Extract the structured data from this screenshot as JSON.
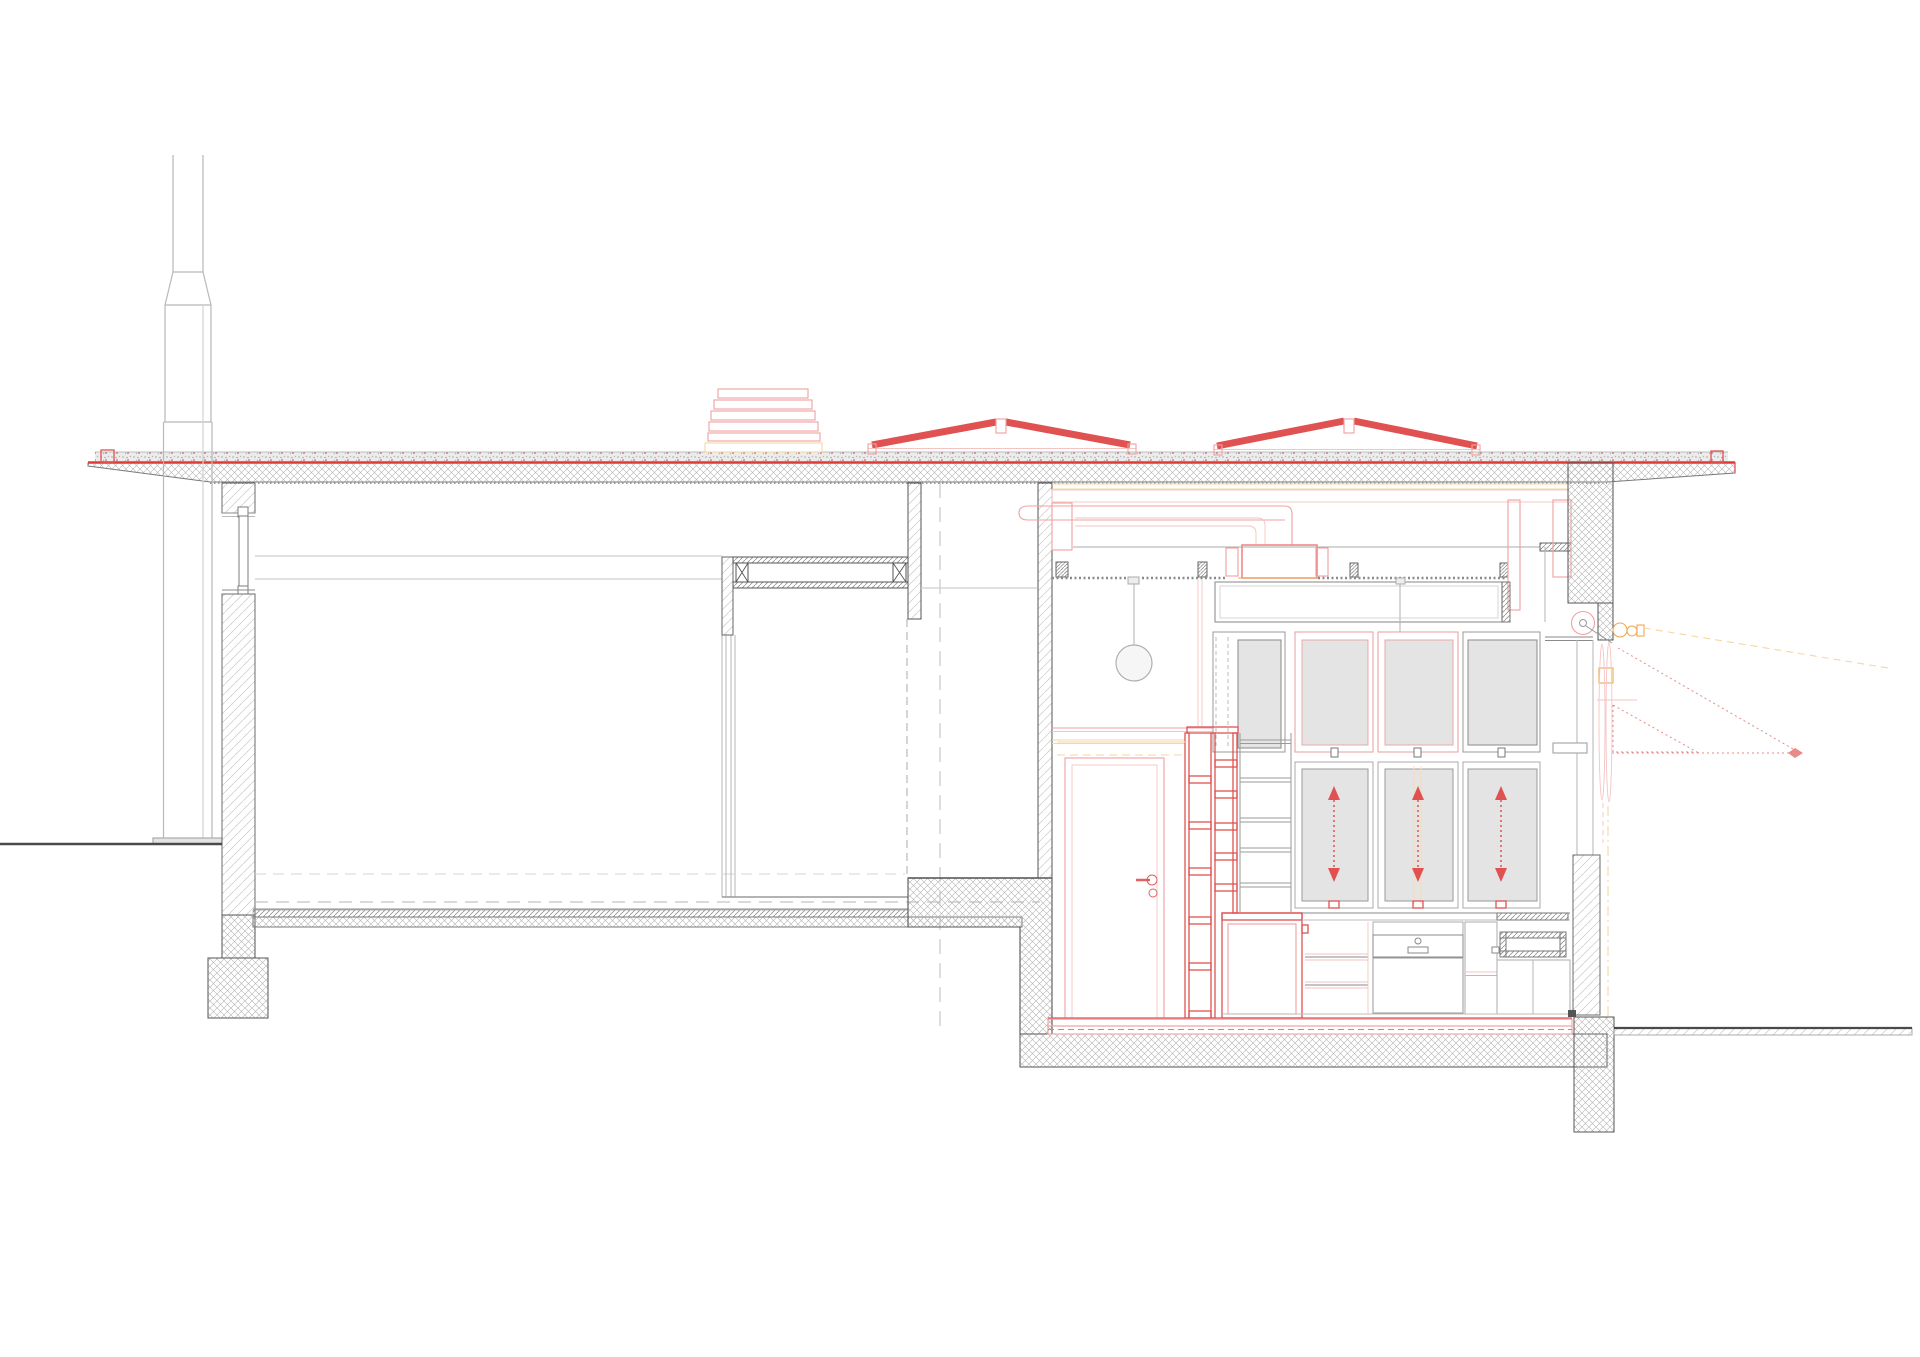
{
  "drawing": {
    "kind": "architectural-cross-section",
    "text_labels": [],
    "counts": {
      "rooflight_monitors": 2,
      "louver_slats": 5,
      "pendant_lights": 2,
      "lift_door_arrows": 3,
      "hopper_windows": 4,
      "bookshelf_shelves": 5,
      "ladder_shelf_rails": 3
    }
  },
  "colors": {
    "paper": "#ffffff",
    "accent_red": "#e05252",
    "bright_red": "#e03a34",
    "light_red": "#f0a0a0",
    "pale_red": "#f6c3c3",
    "orange": "#f0a855",
    "pale_orange": "#f7d6a4",
    "line_dark": "#4f4f4f",
    "line_mid": "#8a8a8a",
    "line_faint": "#bcbcbc",
    "line_light": "#cfcfcf",
    "panel_fill": "#e4e4e4",
    "stipple_bg": "#ececec"
  }
}
